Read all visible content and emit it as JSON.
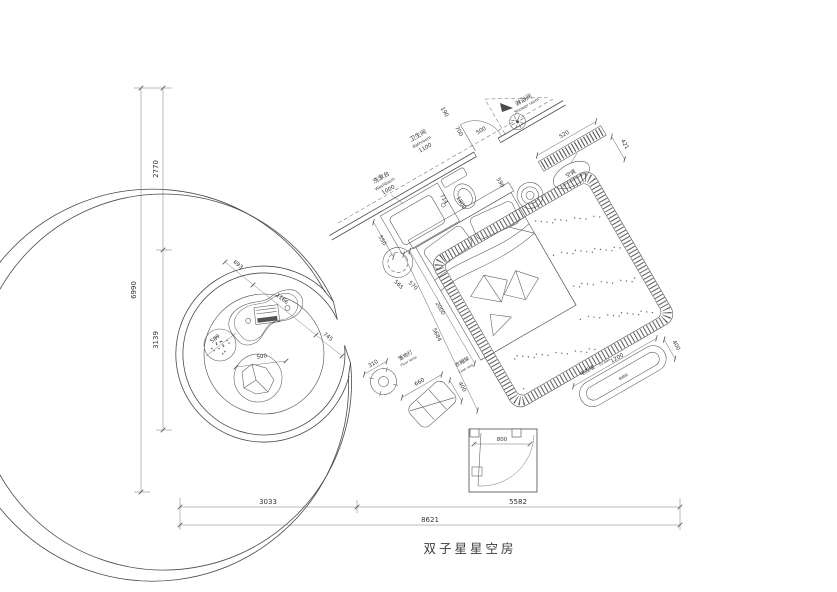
{
  "title": "双子星星空房",
  "dims": {
    "overall_w": "8621",
    "bottom_l": "3033",
    "bottom_r": "5582",
    "overall_h": "6990",
    "left_top": "2770",
    "left_bottom": "3139",
    "entry_door": "800",
    "basin_w": "1000",
    "basin_d": "550",
    "bath_w": "1100",
    "seg_190": "190",
    "seg_700": "700",
    "shower_door": "500",
    "seg_590": "590",
    "seg_714": "714",
    "bed_w": "1800",
    "bed_l": "2000",
    "stool_a": "565",
    "stool_b": "570",
    "diag": "5684",
    "ac_l": "520",
    "ac_d": "421",
    "lamp_d": "310",
    "rack_w": "660",
    "rack_d": "400",
    "tv_w": "1200",
    "tv_d": "400",
    "table_693": "693",
    "table_1166": "1166",
    "table_745": "745",
    "pouf_589": "589",
    "bag_500": "500"
  },
  "labels": {
    "washbasin_cn": "洗漱台",
    "washbasin_en": "Washbasin",
    "bathroom_cn": "卫生间",
    "bathroom_en": "Bathroom",
    "shower_cn": "淋浴间",
    "shower_en": "Shower room",
    "ac_cn": "空调",
    "ac_en": "air-conditioning",
    "lamp_cn": "落地灯",
    "lamp_en": "Floor lamp",
    "coatrack_cn": "衣帽架",
    "coatrack_en": "Coat rack",
    "tv_cn": "电视墙",
    "tv_en": "TV wall",
    "tv_unit": "电视机"
  }
}
